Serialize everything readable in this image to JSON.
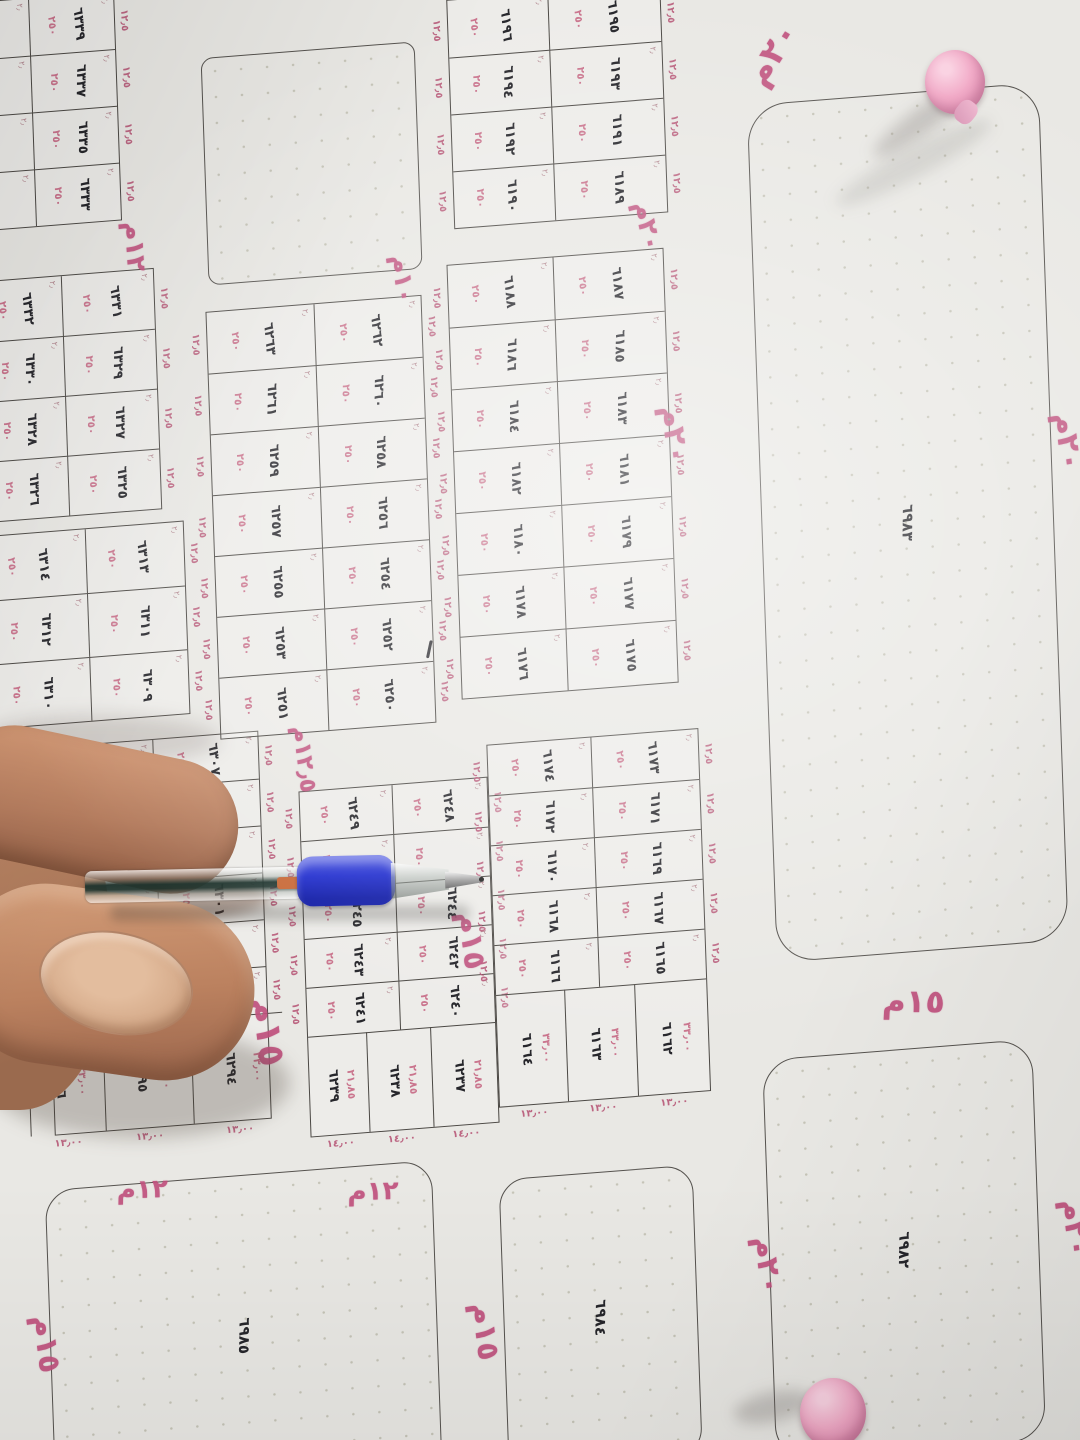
{
  "map": {
    "paper_color": "#e9e8e4",
    "line_color": "#4b4844",
    "pink_color": "#c0517e",
    "number_color": "#26262b",
    "dims": {
      "cell_depth": "٢٥٠",
      "frontage": "١٢٫٥",
      "corner_tick": "٢٫"
    },
    "grid_blocks": [
      {
        "name": "block-6333",
        "x": -28,
        "y": 0,
        "col_widths": [
          55,
          85
        ],
        "row_h": 57,
        "edge_right": true,
        "rows": [
          [
            null,
            "٦٣٣٩"
          ],
          [
            null,
            "٦٣٣٧"
          ],
          [
            null,
            "٦٣٣٥"
          ],
          [
            null,
            "٦٣٣٣"
          ]
        ]
      },
      {
        "name": "block-6325",
        "x": -30,
        "y": 280,
        "col_widths": [
          80,
          92
        ],
        "row_h": 60,
        "edge_right": true,
        "rows": [
          [
            "٦٣٣٢",
            "٦٣٣١"
          ],
          [
            "٦٣٣٠",
            "٦٣٢٩"
          ],
          [
            "٦٣٢٨",
            "٦٣٢٧"
          ],
          [
            "٦٣٢٦",
            "٦٣٢٥"
          ]
        ]
      },
      {
        "name": "block-6309",
        "x": -35,
        "y": 535,
        "col_widths": [
          100,
          98
        ],
        "row_h": 64,
        "edge_right": true,
        "rows": [
          [
            "٦٣١٤",
            "٦٣١٣"
          ],
          [
            "٦٣١٢",
            "٦٣١١"
          ],
          [
            "٦٣١٠",
            "٦٣٠٩"
          ]
        ]
      },
      {
        "name": "block-6297",
        "x": 15,
        "y": 751,
        "col_widths": [
          110,
          105
        ],
        "row_h": 47,
        "edge_right": true,
        "rows": [
          [
            "٦٣٠٨",
            "٦٣٠٧"
          ],
          [
            null,
            "٦٣٠٥"
          ],
          [
            null,
            null
          ],
          [
            null,
            "٦٣٠١"
          ],
          [
            null,
            "٦٢٩٩"
          ],
          [
            null,
            "٦٢٩٧"
          ]
        ],
        "deep": {
          "h": 105,
          "x_off": -25,
          "widths": [
            75,
            88,
            92
          ],
          "nums": [
            "٦٢٩٦",
            "٦٢٩٥",
            "٦٢٩٤"
          ],
          "side": "٣٣٫٠٠",
          "bottom": "١٣٫٠٠"
        }
      },
      {
        "name": "block-6250",
        "x": 194,
        "y": 328,
        "col_widths": [
          107,
          107
        ],
        "row_h": 61,
        "edge_left": true,
        "edge_right": true,
        "rows": [
          [
            "٦٢٦٣",
            "٦٢٦٢"
          ],
          [
            "٦٢٦١",
            "٦٢٦٠"
          ],
          [
            "٦٢٥٩",
            "٦٢٥٨"
          ],
          [
            "٦٢٥٧",
            "٦٢٥٦"
          ],
          [
            "٦٢٥٥",
            "٦٢٥٤"
          ],
          [
            "٦٢٥٣",
            "٦٢٥٢"
          ],
          [
            "٦٢٥١",
            "٦٢٥٠"
          ]
        ]
      },
      {
        "name": "block-6240",
        "x": 270,
        "y": 815,
        "col_widths": [
          92,
          95
        ],
        "row_h": 49,
        "edge_left": true,
        "edge_right": true,
        "rows": [
          [
            "٦٢٤٩",
            "٦٢٤٨"
          ],
          [
            null,
            null
          ],
          [
            "٦٢٤٥",
            "٦٢٤٤"
          ],
          [
            "٦٢٤٣",
            "٦٢٤٢"
          ],
          [
            "٦٢٤١",
            "٦٢٤٠"
          ]
        ],
        "deep": {
          "h": 100,
          "x_off": 0,
          "widths": [
            58,
            64,
            65
          ],
          "nums": [
            "٦٢٣٩",
            "٦٢٣٨",
            "٦٢٣٧"
          ],
          "side": "٢١٫٨٥",
          "bottom": "١٤٫٠٠"
        }
      },
      {
        "name": "block-6189",
        "x": 445,
        "y": 35,
        "col_widths": [
          100,
          112
        ],
        "row_h": 57,
        "edge_left": true,
        "edge_right": true,
        "rows": [
          [
            "٦١٩٦",
            "٦١٩٥"
          ],
          [
            "٦١٩٤",
            "٦١٩٣"
          ],
          [
            "٦١٩٢",
            "٦١٩١"
          ],
          [
            "٦١٩٠",
            "٦١٨٩"
          ]
        ]
      },
      {
        "name": "block-6175",
        "x": 436,
        "y": 300,
        "col_widths": [
          105,
          110
        ],
        "row_h": 62,
        "edge_left": true,
        "edge_right": true,
        "rows": [
          [
            "٦١٨٨",
            "٦١٨٧"
          ],
          [
            "٦١٨٦",
            "٦١٨٥"
          ],
          [
            "٦١٨٤",
            "٦١٨٣"
          ],
          [
            "٦١٨٢",
            "٦١٨١"
          ],
          [
            "٦١٨٠",
            "٦١٧٩"
          ],
          [
            "٦١٧٨",
            "٦١٧٧"
          ],
          [
            "٦١٧٦",
            "٦١٧٥"
          ]
        ]
      },
      {
        "name": "block-6165",
        "x": 459,
        "y": 783,
        "col_widths": [
          103,
          107
        ],
        "row_h": 50,
        "edge_left": true,
        "edge_right": true,
        "rows": [
          [
            "٦١٧٤",
            "٦١٧٣"
          ],
          [
            "٦١٧٢",
            "٦١٧١"
          ],
          [
            "٦١٧٠",
            "٦١٦٩"
          ],
          [
            "٦١٦٨",
            "٦١٦٧"
          ],
          [
            "٦١٦٦",
            "٦١٦٥"
          ]
        ],
        "deep": {
          "h": 112,
          "x_off": 0,
          "widths": [
            68,
            70,
            72
          ],
          "nums": [
            "٦١٦٤",
            "٦١٦٣",
            "٦١٦٢"
          ],
          "side": "٣٣٫٠٠",
          "bottom": "١٣٫٠٠"
        }
      }
    ],
    "open_blocks": [
      {
        "name": "open-block-unnumbered",
        "x": 198,
        "y": 74,
        "w": 212,
        "h": 226,
        "r": 12,
        "num": null
      },
      {
        "name": "open-block-6983",
        "x": 741,
        "y": 164,
        "w": 290,
        "h": 858,
        "r": 40,
        "num": "٦٩٨٣"
      },
      {
        "name": "open-block-6982",
        "x": 723,
        "y": 1120,
        "w": 268,
        "h": 400,
        "r": 35,
        "num": "٦٩٨٢"
      },
      {
        "name": "open-block-6984",
        "x": 456,
        "y": 1219,
        "w": 192,
        "h": 290,
        "r": 28,
        "num": "٦٩٨٤"
      },
      {
        "name": "open-block-6985",
        "x": 3,
        "y": 1194,
        "w": 385,
        "h": 320,
        "r": 30,
        "num": "٦٩٨٥"
      }
    ],
    "street_labels": [
      {
        "text": "١٢م",
        "x": 100,
        "y": 242,
        "rot": 88,
        "size": 26
      },
      {
        "text": "١٠م",
        "x": 368,
        "y": 296,
        "rot": 85,
        "size": 25
      },
      {
        "text": "٢٠م",
        "x": 735,
        "y": 95,
        "rot": -55,
        "size": 34
      },
      {
        "text": "٢٠م",
        "x": 612,
        "y": 262,
        "rot": 80,
        "size": 26
      },
      {
        "text": "٢٠م",
        "x": 628,
        "y": 470,
        "rot": 85,
        "size": 30
      },
      {
        "text": "١٢٫٥م",
        "x": 243,
        "y": 770,
        "rot": 85,
        "size": 23
      },
      {
        "text": "١٥م",
        "x": 196,
        "y": 1032,
        "rot": 85,
        "size": 36
      },
      {
        "text": "١٥م",
        "x": 408,
        "y": 960,
        "rot": 85,
        "size": 30
      },
      {
        "text": "١٥م",
        "x": 845,
        "y": 1054,
        "rot": 5,
        "size": 32
      },
      {
        "text": "٢٠م",
        "x": 692,
        "y": 1308,
        "rot": 85,
        "size": 30
      },
      {
        "text": "١٢م",
        "x": 75,
        "y": 1186,
        "rot": 3,
        "size": 26
      },
      {
        "text": "١٢م",
        "x": 305,
        "y": 1206,
        "rot": 3,
        "size": 26
      },
      {
        "text": "١٥م",
        "x": -30,
        "y": 1330,
        "rot": 85,
        "size": 30
      },
      {
        "text": "١٥م",
        "x": 408,
        "y": 1352,
        "rot": 85,
        "size": 30
      },
      {
        "text": "٢٠م",
        "x": 1020,
        "y": 508,
        "rot": 85,
        "size": 30
      },
      {
        "text": "٢٠م",
        "x": 1000,
        "y": 1295,
        "rot": 85,
        "size": 30
      }
    ],
    "top_edge_cells": [
      {
        "x": 688,
        "y": 24,
        "w": 124,
        "h": 76,
        "label": "٢٠٫٠٢"
      },
      {
        "x": 813,
        "y": 39,
        "w": 124,
        "h": 70,
        "label": "٢٠٫٠١"
      }
    ],
    "stray_mark": {
      "x": 404,
      "y": 674
    }
  }
}
